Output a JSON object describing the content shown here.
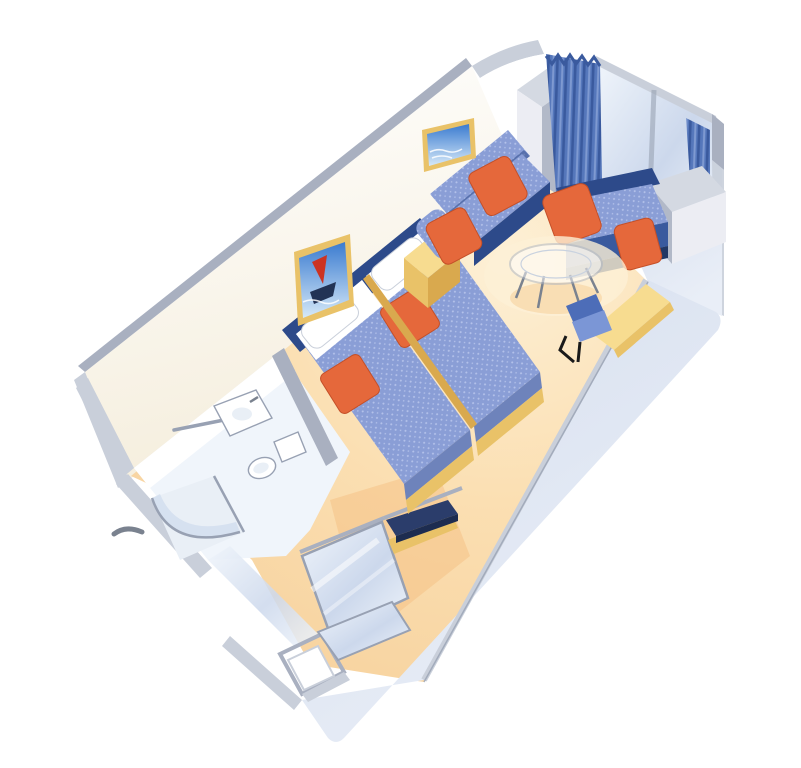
{
  "scene": {
    "title": "Cruise ship stateroom - 3D isometric cutaway floor plan illustration",
    "view": "axonometric cutaway, rotated plan, white background, no text labels",
    "rooms": [
      {
        "name": "main-cabin",
        "objects": [
          "twin-bed-left",
          "twin-bed-right",
          "headboard-panel",
          "white-pillows",
          "orange-throw-cushions",
          "gold-bed-trim",
          "nightstand",
          "sofa",
          "sofa-orange-pillows",
          "artwork-seascape",
          "artwork-sailboat",
          "round-glass-table",
          "desk-counter",
          "desk-chair",
          "luggage-bench"
        ]
      },
      {
        "name": "window-bay",
        "objects": [
          "pleated-curtain",
          "curtain-sliver",
          "window-seat",
          "window-seat-orange-pillows",
          "glass-end-wall",
          "gray-column-cabinet",
          "side-cabinet"
        ]
      },
      {
        "name": "bathroom",
        "objects": [
          "shower-enclosure",
          "shower-glass-door",
          "sink-vanity",
          "toilet",
          "towel-bar",
          "exterior-handle"
        ]
      },
      {
        "name": "entry",
        "objects": [
          "mirrored-wardrobe-doors",
          "gold-baseboard",
          "entry-door"
        ]
      }
    ]
  },
  "colors": {
    "bg": "#ffffff",
    "wallFaceTop": "#ffffff",
    "wallFaceBot": "#f5eedd",
    "wallCap": "#a9b0c0",
    "wallCapLight": "#c9cfda",
    "nearWall1": "#e9eef7",
    "nearWall2": "#d5deee",
    "glass1": "#f0f5fb",
    "glass2": "#ccd8ec",
    "floorLight": "#fdf0d6",
    "floorMid": "#fbdfb2",
    "floorDark": "#f6cf99",
    "floorGlowWarm": "#f5bc7e",
    "navy": "#2d4a8a",
    "navyDark": "#223764",
    "spread": "#8a9ed6",
    "spreadDot": "#b4c2ea",
    "spreadSide": "#6e83bb",
    "orange": "#e5683b",
    "orangeDark": "#c44f28",
    "gold": "#e9c268",
    "goldDark": "#d9a94e",
    "goldLight": "#f7dc90",
    "curtain1": "#5577bb",
    "curtain2": "#3a5a9e",
    "curtain3": "#7f9ad1",
    "column1": "#d4d9e2",
    "column2": "#b2b9c8",
    "column3": "#ecedf3",
    "fixLine": "#98a1b3",
    "fixFill": "#ffffff",
    "fixShade": "#e9eff6",
    "chairLight": "#7b96d6",
    "chairDark": "#4d6db8",
    "sea": "#3a7bd0",
    "seaLight": "#d6e9f8",
    "sailRed": "#cc3322",
    "hullDark": "#223355",
    "benchNavy": "#2b3d6b",
    "benchEdge": "#1d2c50",
    "metal": "#7a828f",
    "white": "#ffffff"
  }
}
